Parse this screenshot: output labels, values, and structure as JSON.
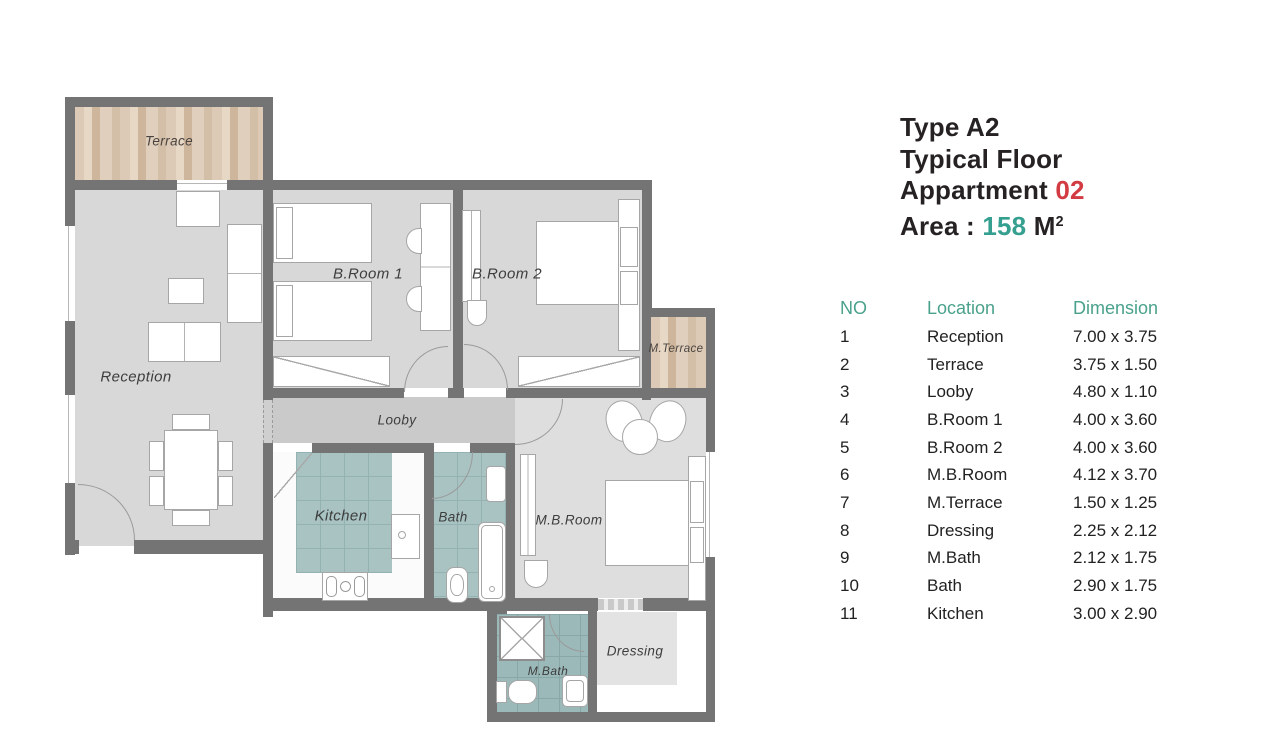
{
  "title_block": {
    "line1": "Type A2",
    "line2": "Typical Floor",
    "line3": {
      "text": "Appartment",
      "number": "02"
    },
    "line4": {
      "label": "Area :",
      "value": "158",
      "unit": "M",
      "unit_sup": "2"
    }
  },
  "table": {
    "headers": {
      "no": "NO",
      "location": "Location",
      "dimension": "Dimension"
    },
    "rows": [
      {
        "no": "1",
        "location": "Reception",
        "dimension": "7.00 x 3.75"
      },
      {
        "no": "2",
        "location": "Terrace",
        "dimension": "3.75 x 1.50"
      },
      {
        "no": "3",
        "location": "Looby",
        "dimension": "4.80 x 1.10"
      },
      {
        "no": "4",
        "location": "B.Room 1",
        "dimension": "4.00 x 3.60"
      },
      {
        "no": "5",
        "location": "B.Room 2",
        "dimension": "4.00 x 3.60"
      },
      {
        "no": "6",
        "location": "M.B.Room",
        "dimension": "4.12 x 3.70"
      },
      {
        "no": "7",
        "location": "M.Terrace",
        "dimension": "1.50 x 1.25"
      },
      {
        "no": "8",
        "location": "Dressing",
        "dimension": "2.25 x 2.12"
      },
      {
        "no": "9",
        "location": "M.Bath",
        "dimension": "2.12 x 1.75"
      },
      {
        "no": "10",
        "location": "Bath",
        "dimension": "2.90 x 1.75"
      },
      {
        "no": "11",
        "location": "Kitchen",
        "dimension": "3.00 x 2.90"
      }
    ]
  },
  "floor_plan": {
    "labels": {
      "terrace": "Terrace",
      "reception": "Reception",
      "broom1": "B.Room 1",
      "broom2": "B.Room 2",
      "mterrace": "M.Terrace",
      "looby": "Looby",
      "kitchen": "Kitchen",
      "bath": "Bath",
      "mbroom": "M.B.Room",
      "mbath": "M.Bath",
      "dressing": "Dressing"
    }
  },
  "colors": {
    "wall": "#747474",
    "room_fill": "#d8d8d8",
    "looby_fill": "#cacaca",
    "wood_base": "#dcc9b6",
    "tile_teal": "#a9c3c3",
    "tile_teal_dark": "#9cb9b9",
    "accent_red": "#d23b42",
    "accent_teal": "#359f90",
    "table_header_teal": "#4aa18c"
  }
}
